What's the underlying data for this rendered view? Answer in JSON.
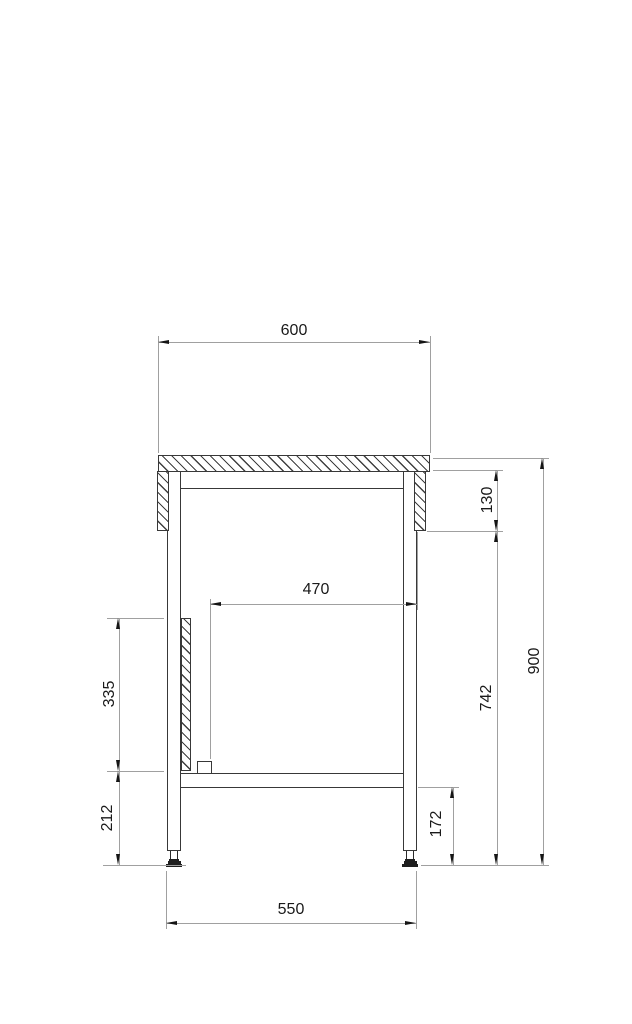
{
  "meta": {
    "type": "technical-drawing",
    "subject": "workbench side-view section with dimensions"
  },
  "colors": {
    "background": "#ffffff",
    "object_line": "#383838",
    "dimension_line": "#a0a0a0",
    "arrow": "#151515",
    "text": "#1a1a1a",
    "foot_fill": "#1e1e1e"
  },
  "dimensions": {
    "top_width": "600",
    "apron_drop": "130",
    "inner_clear_width": "470",
    "side_panel_height": "335",
    "under_top_to_floor": "742",
    "overall_height": "900",
    "panel_bottom_to_floor": "212",
    "shelf_underside_to_floor": "172",
    "leg_outer_span": "550"
  }
}
